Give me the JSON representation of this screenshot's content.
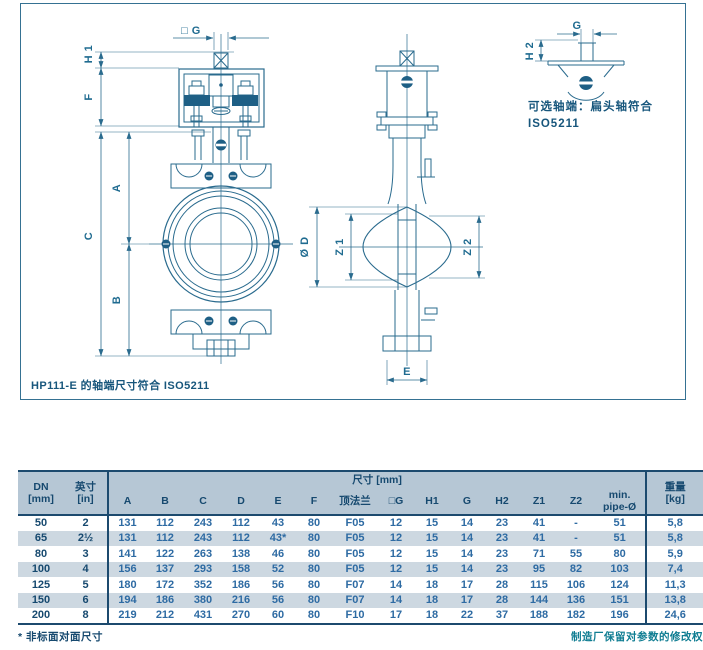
{
  "colors": {
    "accent": "#1e5f85",
    "drawing_line": "#2a6b8e",
    "table_header_bg": "#b6c7d5",
    "row_alt_bg": "#cdd8e1",
    "dark_rule": "#1c4a6e",
    "number_blue": "#2e6ba3",
    "footer_teal": "#0f7d92"
  },
  "drawing": {
    "caption": "HP111-E 的轴端尺寸符合 ISO5211",
    "inset_note_line1": "可选轴端：扁头轴符合",
    "inset_note_line2": "ISO5211",
    "labels": {
      "h1": "H 1",
      "g_square": "□ G",
      "f": "F",
      "a": "A",
      "b": "B",
      "c": "C",
      "dia_d": "Ø D",
      "z1": "Z 1",
      "z2": "Z 2",
      "e": "E",
      "g": "G",
      "h2": "H 2"
    }
  },
  "table": {
    "group_headers": {
      "dn_line1": "DN",
      "dn_line2": "[mm]",
      "in_line1": "英寸",
      "in_line2": "[in]",
      "dims_banner": "尺寸 [mm]",
      "weight_line1": "重量",
      "weight_line2": "[kg]"
    },
    "columns": [
      "A",
      "B",
      "C",
      "D",
      "E",
      "F",
      "顶法兰",
      "□G",
      "H1",
      "G",
      "H2",
      "Z1",
      "Z2"
    ],
    "min_pipe_line1": "min.",
    "min_pipe_line2": "pipe-Ø",
    "rows": [
      [
        "50",
        "2",
        "131",
        "112",
        "243",
        "112",
        "43",
        "80",
        "F05",
        "12",
        "15",
        "14",
        "23",
        "41",
        "-",
        "51",
        "5,8"
      ],
      [
        "65",
        "2½",
        "131",
        "112",
        "243",
        "112",
        "43*",
        "80",
        "F05",
        "12",
        "15",
        "14",
        "23",
        "41",
        "-",
        "51",
        "5,8"
      ],
      [
        "80",
        "3",
        "141",
        "122",
        "263",
        "138",
        "46",
        "80",
        "F05",
        "12",
        "15",
        "14",
        "23",
        "71",
        "55",
        "80",
        "5,9"
      ],
      [
        "100",
        "4",
        "156",
        "137",
        "293",
        "158",
        "52",
        "80",
        "F05",
        "12",
        "15",
        "14",
        "23",
        "95",
        "82",
        "103",
        "7,4"
      ],
      [
        "125",
        "5",
        "180",
        "172",
        "352",
        "186",
        "56",
        "80",
        "F07",
        "14",
        "18",
        "17",
        "28",
        "115",
        "106",
        "124",
        "11,3"
      ],
      [
        "150",
        "6",
        "194",
        "186",
        "380",
        "216",
        "56",
        "80",
        "F07",
        "14",
        "18",
        "17",
        "28",
        "144",
        "136",
        "151",
        "13,8"
      ],
      [
        "200",
        "8",
        "219",
        "212",
        "431",
        "270",
        "60",
        "80",
        "F10",
        "17",
        "18",
        "22",
        "37",
        "188",
        "182",
        "196",
        "24,6"
      ]
    ]
  },
  "footnotes": {
    "left": "* 非标面对面尺寸",
    "right": "制造厂保留对参数的修改权"
  }
}
